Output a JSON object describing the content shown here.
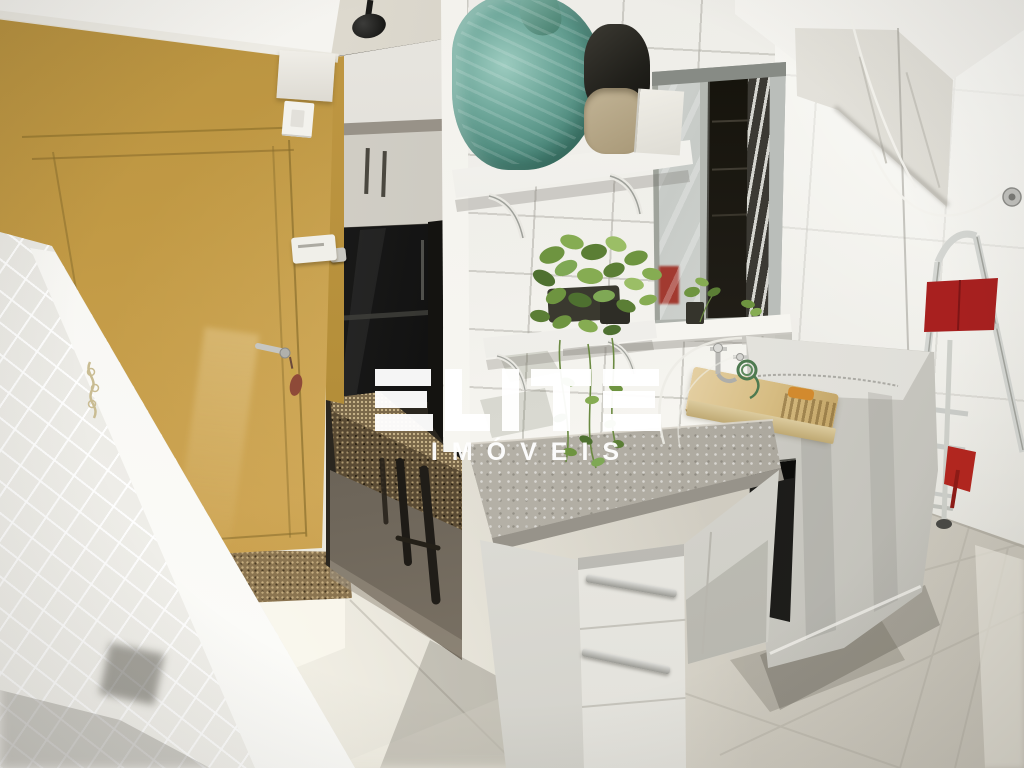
{
  "watermark": {
    "brand": "ELITE",
    "subtitle": "IMÓVEIS",
    "color": "#FFFFFF"
  },
  "scene": {
    "description": "Bright laundry/service area seen from the corner: a mustard-yellow kitchen door on the left, doorway revealing dark refrigerator and granite bar, white tiled walls, storage shelf with bags, trailing potted plant, aluminium sliding window, laundry tap with washboard sink, washing machine under a fabric cover, black trash bin, folded step ladder with red cloth, clothesline cords and large light floor tiles",
    "objects": [
      "yellow-door",
      "door-handle",
      "door-keys",
      "light-switch",
      "kitchen-doorway",
      "refrigerator",
      "upper-cabinets",
      "ceiling-spotlight",
      "granite-bar",
      "bar-stool",
      "diamond-tile-wall",
      "storage-shelf",
      "teal-plastic-bag",
      "black-bag",
      "beige-bag",
      "white-box",
      "plant-shelf",
      "trailing-plant",
      "sliding-window",
      "window-blind-slats",
      "window-sill",
      "laundry-faucet",
      "garden-hose",
      "washboard-sink",
      "covered-washing-machine",
      "gray-bucket",
      "trash-bin",
      "step-ladder",
      "red-cloth",
      "red-dustpan",
      "wall-cabinet",
      "clothesline",
      "wall-hook",
      "floor-tiles",
      "granite-threshold"
    ]
  },
  "palette": {
    "wall_yellow": "#C49C49",
    "door_seam": "#8A6F2E",
    "tile_white": "#F1F0EB",
    "diamond_tile": "#E4E3DE",
    "window_frame": "#A8ACA8",
    "window_interior": "#201D16",
    "teal_bag": "#5E9C90",
    "plant_green": "#6E9440",
    "counter_concrete": "#B4B0A6",
    "cabinet_white": "#EDECE7",
    "machine_cover": "#D8D7D1",
    "washboard_beige": "#D3B87E",
    "ladder_metal": "#D4D6D2",
    "red_cloth": "#A8201F",
    "floor_tile": "#D7D3C8",
    "granite_brown": "#5C4D35",
    "trash_black": "#1F1F1C",
    "ceiling_white": "#F4F3EF",
    "watermark": "#FFFFFF"
  }
}
